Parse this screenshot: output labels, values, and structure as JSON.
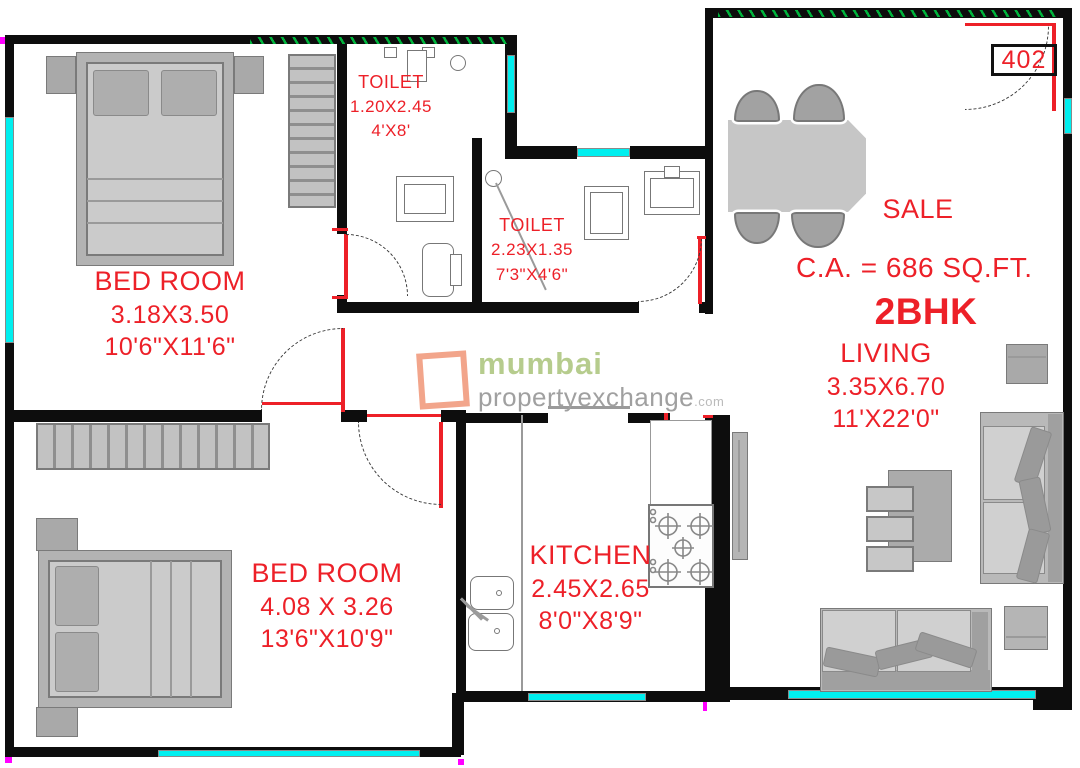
{
  "plan": {
    "unit_number": "402",
    "sale_label": "SALE",
    "carpet_area": "C.A. = 686 SQ.FT.",
    "unit_type": "2BHK"
  },
  "rooms": {
    "bedroom1": {
      "name": "BED ROOM",
      "size_m": "3.18X3.50",
      "size_ft": "10'6\"X11'6\""
    },
    "bedroom2": {
      "name": "BED ROOM",
      "size_m": "4.08 X 3.26",
      "size_ft": "13'6\"X10'9\""
    },
    "toilet1": {
      "name": "TOILET",
      "size_m": "1.20X2.45",
      "size_ft": "4'X8'"
    },
    "toilet2": {
      "name": "TOILET",
      "size_m": "2.23X1.35",
      "size_ft": "7'3\"X4'6\""
    },
    "kitchen": {
      "name": "KITCHEN",
      "size_m": "2.45X2.65",
      "size_ft": "8'0\"X8'9\""
    },
    "living": {
      "name": "LIVING",
      "size_m": "3.35X6.70",
      "size_ft": "11'X22'0\""
    }
  },
  "watermark": {
    "brand": "mumbai",
    "domain": "propertyexchange",
    "tld": ".com"
  },
  "colors": {
    "label_red": "#ed2028",
    "window_cyan": "#00efef",
    "hatch_green": "#00b43c",
    "wall_black": "#0d0d0d",
    "door_frame_red": "#ed2028",
    "logo_green": "#b6cc8d",
    "logo_gray": "#a0a0a0",
    "logo_orange": "#f2a58b",
    "furniture_gray": "#c7c7c7"
  }
}
